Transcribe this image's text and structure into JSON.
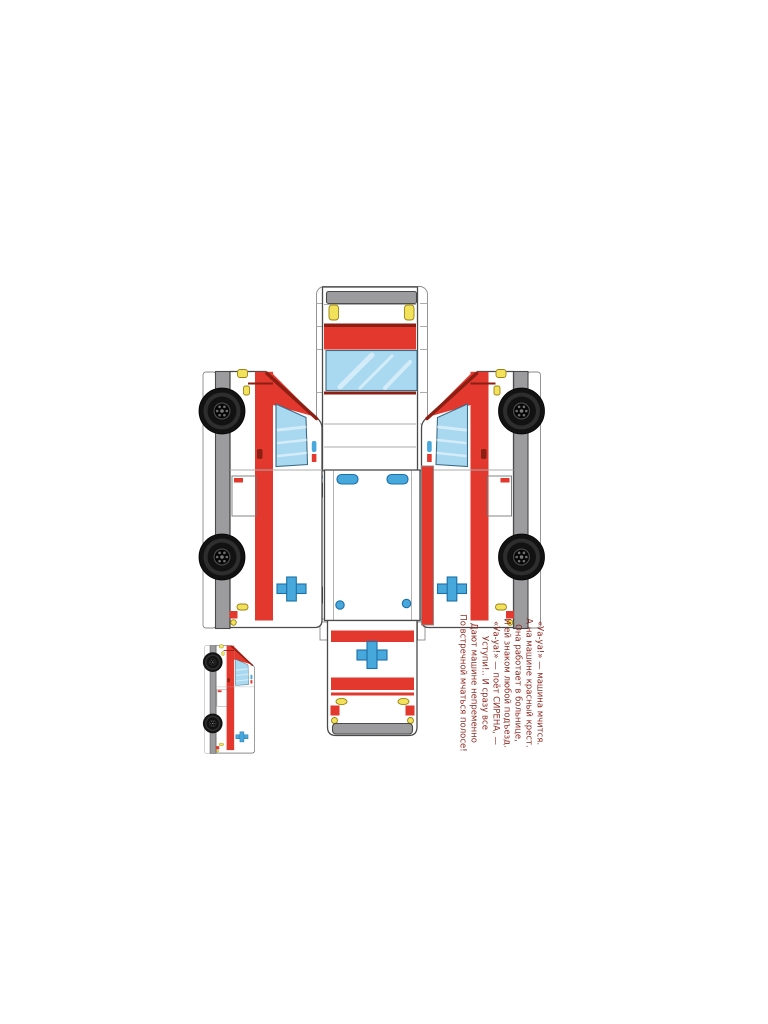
{
  "sheet": {
    "kind": "papercraft cut-out template",
    "subject": "ambulance van paper model",
    "parts": {
      "front_top_strip": "front-bumper-hood-windshield-roof-strip",
      "left_side_panel": "vehicle-left-side-with-wheels",
      "right_side_panel": "vehicle-right-side-with-wheels",
      "rear_wall_panel": "rear-wall-with-beacon-lights",
      "rear_door_flap": "rear-doors-with-red-cross",
      "assembled_preview": "small-finished-model-picture"
    },
    "icons": {
      "red_cross_icon": "blue medical cross",
      "beacon_light_icon": "blue roof beacon",
      "headlight_icon": "yellow headlight",
      "taillight_icon": "yellow taillight",
      "wheel_icon": "black tire with hub"
    }
  },
  "poem": {
    "lines": [
      "«Уа-уа!» — машина мчится.",
      "А на машине красный крест.",
      "Она работает в больнице,",
      "И ей знаком любой подъезд.",
      "«Уа-уа!» — поёт СИРЕНА, —",
      "Уступи!.. И сразу все",
      "Дают машине непременно",
      "По встречной мчаться полосе!"
    ]
  },
  "colors": {
    "red": "#E2382D",
    "dark_red": "#8C1F14",
    "window_blue": "#A9D8F1",
    "cross_blue": "#47A8DC",
    "beacon_outline": "#1D6FA8",
    "gray": "#9C9C9E",
    "yellow": "#F2E15A",
    "yellow_outline": "#9B8313",
    "outline": "#4A4A4A",
    "tab_outline": "#8A8A8A",
    "fold_line": "#ABABAB",
    "poem_text": "#8A2A22",
    "paper": "#FFFFFF"
  }
}
